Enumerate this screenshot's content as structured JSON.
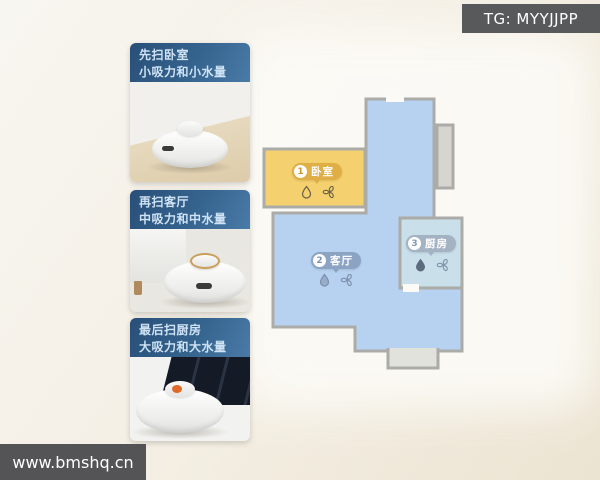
{
  "watermarks": {
    "top_right": "TG: MYYJJPP",
    "bottom_left": "www.bmshq.cn"
  },
  "steps": [
    {
      "title": "先扫卧室",
      "subtitle": "小吸力和小水量"
    },
    {
      "title": "再扫客厅",
      "subtitle": "中吸力和中水量"
    },
    {
      "title": "最后扫厨房",
      "subtitle": "大吸力和大水量"
    }
  ],
  "map": {
    "rooms": [
      {
        "number": "1",
        "name": "卧室",
        "fill": "#f4d16e",
        "badge_color": "#dfae45",
        "water_icon": "droplet-outline",
        "suction_icon": "fan-pinwheel"
      },
      {
        "number": "2",
        "name": "客厅",
        "fill": "#b7d2f1",
        "badge_color": "#8ca3c3",
        "water_icon": "droplet-half",
        "suction_icon": "fan-pinwheel"
      },
      {
        "number": "3",
        "name": "厨房",
        "fill": "#c9dfe9",
        "badge_color": "#a3b3c4",
        "water_icon": "droplet-full",
        "suction_icon": "fan-pinwheel"
      }
    ],
    "wall_color": "#ababa8"
  }
}
